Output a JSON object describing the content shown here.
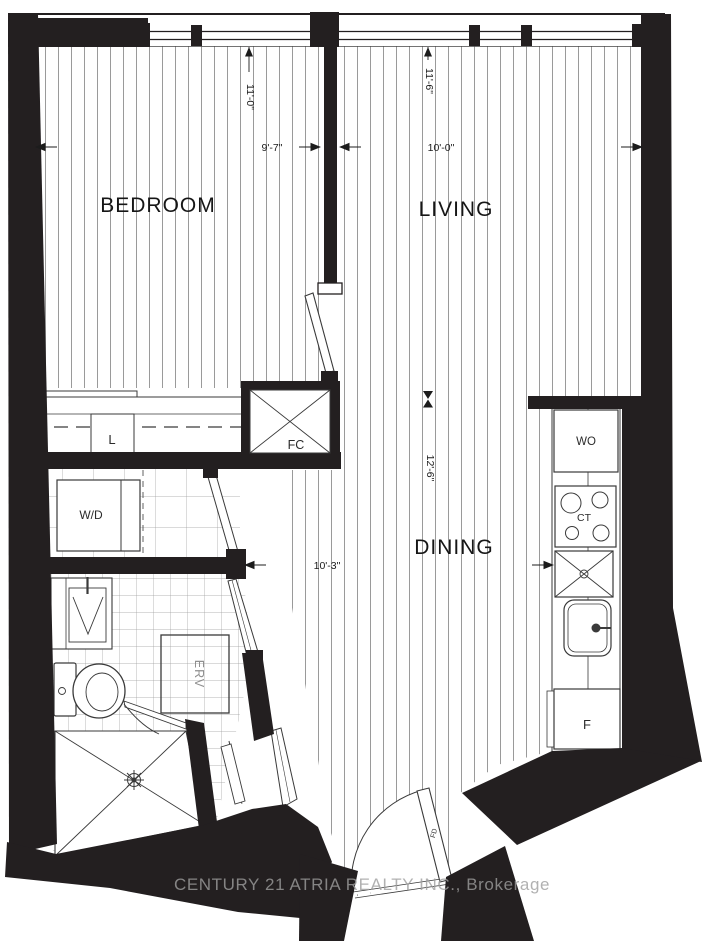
{
  "floorplan": {
    "rooms": {
      "bedroom": "BEDROOM",
      "living": "LIVING",
      "dining": "DINING"
    },
    "dimensions": {
      "bedroom_vertical": "11'-0\"",
      "bedroom_horizontal": "9'-7\"",
      "living_vertical": "11'-6\"",
      "living_horizontal": "10'-0\"",
      "dining_vertical": "12'-6\"",
      "dining_horizontal": "10'-3\""
    },
    "fixtures": {
      "linen_closet": "L",
      "fan_coil": "FC",
      "washer_dryer": "W/D",
      "wall_oven": "WO",
      "cooktop": "CT",
      "fridge": "F",
      "erv": "ERV",
      "entry_door": "FD"
    },
    "watermark": "CENTURY 21 ATRIA REALTY INC., Brokerage",
    "colors": {
      "wall": "#231f20",
      "fixture_line": "#3a3a3a",
      "hatch_line": "#6e6e6e",
      "tile_line": "#9d9d9d",
      "text": "#1c1c1c",
      "watermark": "#9e9e9e"
    }
  }
}
